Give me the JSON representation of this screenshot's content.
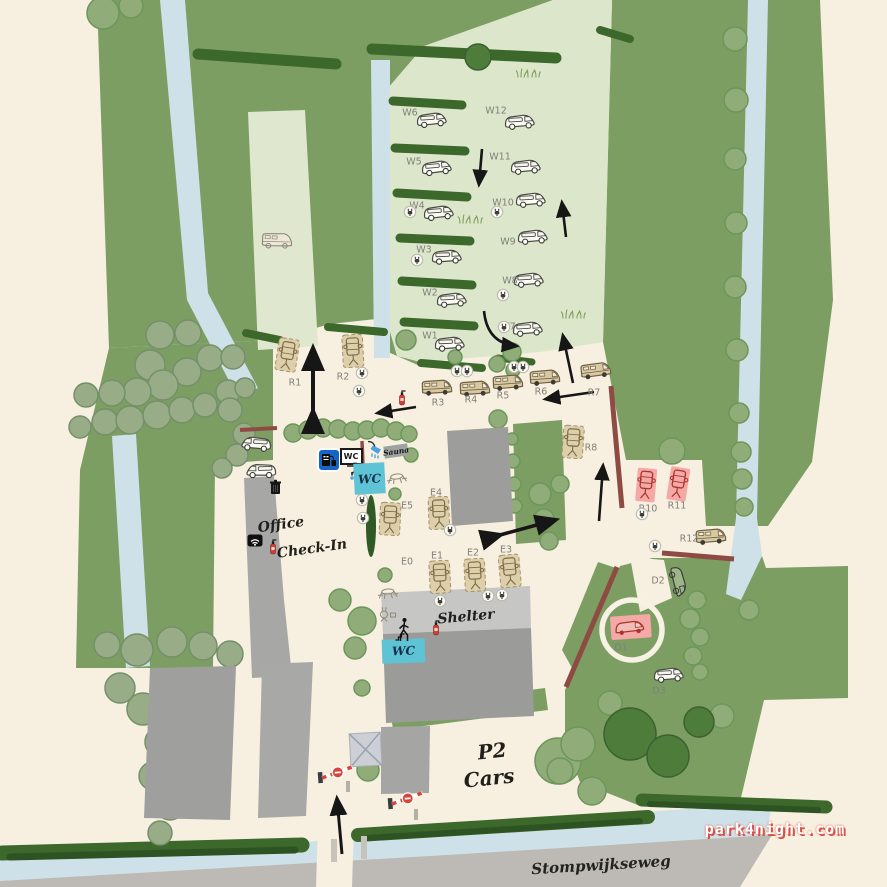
{
  "watermark": "park4night.com",
  "road_name": "Stompwijkseweg",
  "colors": {
    "cream": "#f7efe0",
    "field_green": "#7d9e63",
    "light_field": "#dce6cb",
    "water": "#cfe1e8",
    "hedge": "#3c682c",
    "road": "#bdbab5",
    "fence": "#8d4b43",
    "wc_teal": "#5fc3d6",
    "pink_spot": "#f5a9a6",
    "red_sketch": "#a8352c",
    "service_blue": "#1565c5",
    "arrow": "#161616"
  },
  "area_labels": [
    {
      "id": "office",
      "text": "Office",
      "x": 281,
      "y": 525,
      "size": 14,
      "rot": -8
    },
    {
      "id": "check-in",
      "text": "Check-In",
      "x": 312,
      "y": 549,
      "size": 14,
      "rot": -8
    },
    {
      "id": "shelter",
      "text": "Shelter",
      "x": 466,
      "y": 617,
      "size": 14,
      "rot": -5
    },
    {
      "id": "p2",
      "text": "P2",
      "x": 492,
      "y": 751,
      "size": 20,
      "rot": -6
    },
    {
      "id": "cars",
      "text": "Cars",
      "x": 489,
      "y": 778,
      "size": 20,
      "rot": -6
    }
  ],
  "pitches": [
    {
      "id": "W1",
      "type": "van",
      "x": 450,
      "y": 345,
      "r": -2,
      "lx": 430,
      "ly": 336
    },
    {
      "id": "W2",
      "type": "van",
      "x": 452,
      "y": 301,
      "r": -3,
      "lx": 430,
      "ly": 293
    },
    {
      "id": "W3",
      "type": "van",
      "x": 447,
      "y": 258,
      "r": -2,
      "lx": 424,
      "ly": 250
    },
    {
      "id": "W4",
      "type": "van",
      "x": 439,
      "y": 214,
      "r": -4,
      "lx": 417,
      "ly": 206
    },
    {
      "id": "W5",
      "type": "van",
      "x": 437,
      "y": 169,
      "r": -5,
      "lx": 414,
      "ly": 162
    },
    {
      "id": "W6",
      "type": "van",
      "x": 432,
      "y": 121,
      "r": -4,
      "lx": 410,
      "ly": 113
    },
    {
      "id": "W7",
      "type": "van",
      "x": 528,
      "y": 330,
      "r": -3,
      "lx": 508,
      "ly": 327
    },
    {
      "id": "W8",
      "type": "van",
      "x": 529,
      "y": 281,
      "r": -3,
      "lx": 510,
      "ly": 281
    },
    {
      "id": "W9",
      "type": "van",
      "x": 533,
      "y": 238,
      "r": -3,
      "lx": 508,
      "ly": 242
    },
    {
      "id": "W10",
      "type": "van",
      "x": 531,
      "y": 201,
      "r": -3,
      "lx": 503,
      "ly": 203
    },
    {
      "id": "W11",
      "type": "van",
      "x": 526,
      "y": 168,
      "r": -3,
      "lx": 500,
      "ly": 157
    },
    {
      "id": "W12",
      "type": "van",
      "x": 520,
      "y": 123,
      "r": -3,
      "lx": 496,
      "ly": 111
    },
    {
      "id": "R1",
      "type": "plot",
      "x": 287,
      "y": 357,
      "r": 9,
      "lx": 295,
      "ly": 383
    },
    {
      "id": "R2",
      "type": "plot",
      "x": 353,
      "y": 353,
      "r": -3,
      "lx": 343,
      "ly": 377
    },
    {
      "id": "R3",
      "type": "rv",
      "x": 437,
      "y": 389,
      "r": -2,
      "lx": 438,
      "ly": 403
    },
    {
      "id": "R4",
      "type": "rv",
      "x": 475,
      "y": 390,
      "r": -2,
      "lx": 471,
      "ly": 400
    },
    {
      "id": "R5",
      "type": "rv",
      "x": 508,
      "y": 384,
      "r": -3,
      "lx": 503,
      "ly": 396
    },
    {
      "id": "R6",
      "type": "rv",
      "x": 545,
      "y": 379,
      "r": -3,
      "lx": 541,
      "ly": 392
    },
    {
      "id": "R7",
      "type": "rv",
      "x": 596,
      "y": 372,
      "r": -6,
      "lx": 594,
      "ly": 393
    },
    {
      "id": "R8",
      "type": "plot",
      "x": 573,
      "y": 444,
      "r": 4,
      "lx": 591,
      "ly": 448
    },
    {
      "id": "R10",
      "type": "pinkplot",
      "x": 646,
      "y": 487,
      "r": 5,
      "lx": 648,
      "ly": 509
    },
    {
      "id": "R11",
      "type": "pinkplot",
      "x": 678,
      "y": 486,
      "r": 9,
      "lx": 677,
      "ly": 506
    },
    {
      "id": "R12",
      "type": "rv",
      "x": 711,
      "y": 538,
      "r": -3,
      "lx": 689,
      "ly": 539
    },
    {
      "id": "E0",
      "type": "none",
      "x": 407,
      "y": 562,
      "r": 0,
      "lx": 407,
      "ly": 562
    },
    {
      "id": "E1",
      "type": "plot",
      "x": 440,
      "y": 579,
      "r": -3,
      "lx": 437,
      "ly": 556
    },
    {
      "id": "E2",
      "type": "plot",
      "x": 475,
      "y": 577,
      "r": -3,
      "lx": 473,
      "ly": 553
    },
    {
      "id": "E3",
      "type": "plot",
      "x": 510,
      "y": 573,
      "r": -5,
      "lx": 506,
      "ly": 550
    },
    {
      "id": "E4",
      "type": "plot",
      "x": 439,
      "y": 515,
      "r": -2,
      "lx": 436,
      "ly": 493
    },
    {
      "id": "E5",
      "type": "plot",
      "x": 390,
      "y": 521,
      "r": 3,
      "lx": 407,
      "ly": 506
    },
    {
      "id": "D1",
      "type": "pinkvan",
      "x": 631,
      "y": 629,
      "r": -4,
      "lx": 621,
      "ly": 648
    },
    {
      "id": "D2",
      "type": "vanv",
      "x": 677,
      "y": 582,
      "r": 78,
      "lx": 658,
      "ly": 581
    },
    {
      "id": "D3",
      "type": "van",
      "x": 669,
      "y": 676,
      "r": -3,
      "lx": 659,
      "ly": 691
    }
  ],
  "amenities": [
    {
      "t": "service",
      "n": "service-station-sign",
      "x": 329,
      "y": 462,
      "r": 0
    },
    {
      "t": "wcsign",
      "n": "wc-sign",
      "x": 349,
      "y": 454,
      "r": 0,
      "text": "WC"
    },
    {
      "t": "tap",
      "n": "water-tap-icon",
      "x": 352,
      "y": 472,
      "r": 0
    },
    {
      "t": "shower",
      "n": "shower-icon",
      "x": 374,
      "y": 452,
      "r": 0
    },
    {
      "t": "saunasign",
      "n": "sauna-sign",
      "x": 396,
      "y": 451,
      "r": -8,
      "text": "Sauna"
    },
    {
      "t": "wcb",
      "n": "wc-building",
      "x": 369,
      "y": 478,
      "w": 31,
      "h": 31,
      "r": -3,
      "text": "WC"
    },
    {
      "t": "wcb",
      "n": "wc-building",
      "x": 403,
      "y": 651,
      "w": 43,
      "h": 24,
      "r": -2,
      "text": "WC"
    },
    {
      "t": "wifi",
      "n": "wifi-icon",
      "x": 255,
      "y": 542,
      "r": 0
    },
    {
      "t": "ext",
      "n": "fire-extinguisher-icon",
      "x": 273,
      "y": 549,
      "r": 0
    },
    {
      "t": "ext",
      "n": "fire-extinguisher-icon",
      "x": 402,
      "y": 400,
      "r": 0
    },
    {
      "t": "ext",
      "n": "fire-extinguisher-icon",
      "x": 436,
      "y": 630,
      "r": 0
    },
    {
      "t": "trash",
      "n": "trash-bin-icon",
      "x": 276,
      "y": 489,
      "r": 0
    },
    {
      "t": "picnic",
      "n": "picnic-table-icon",
      "x": 397,
      "y": 479,
      "r": -8
    },
    {
      "t": "picnic",
      "n": "picnic-table-icon",
      "x": 388,
      "y": 594,
      "r": -5
    },
    {
      "t": "person",
      "n": "person-stairs-icon",
      "x": 403,
      "y": 632,
      "r": 0
    },
    {
      "t": "grill",
      "n": "grill-icon",
      "x": 387,
      "y": 616,
      "r": 0
    },
    {
      "t": "grass",
      "n": "grass-tuft",
      "x": 528,
      "y": 73,
      "r": 0
    },
    {
      "t": "grass",
      "n": "grass-tuft",
      "x": 470,
      "y": 219,
      "r": 0
    },
    {
      "t": "grass",
      "n": "grass-tuft",
      "x": 573,
      "y": 314,
      "r": 0
    },
    {
      "t": "grass",
      "n": "grass-tuft",
      "x": 716,
      "y": 600,
      "r": 0
    },
    {
      "t": "barrier",
      "n": "entry-barrier",
      "x": 336,
      "y": 776,
      "r": -4
    },
    {
      "t": "barrier",
      "n": "entry-barrier",
      "x": 406,
      "y": 802,
      "r": -4
    },
    {
      "t": "vanl",
      "n": "campervan-icon",
      "x": 256,
      "y": 445,
      "r": 3
    },
    {
      "t": "vanl",
      "n": "campervan-icon",
      "x": 261,
      "y": 472,
      "r": -2
    },
    {
      "t": "rvsketch",
      "n": "motorhome-icon",
      "x": 277,
      "y": 242,
      "r": 2
    }
  ],
  "hookups": [
    [
      410,
      213
    ],
    [
      497,
      213
    ],
    [
      417,
      261
    ],
    [
      503,
      296
    ],
    [
      504,
      328
    ],
    [
      362,
      374
    ],
    [
      359,
      392
    ],
    [
      457,
      372
    ],
    [
      467,
      372
    ],
    [
      514,
      368
    ],
    [
      523,
      368
    ],
    [
      362,
      501
    ],
    [
      363,
      519
    ],
    [
      450,
      531
    ],
    [
      440,
      602
    ],
    [
      488,
      597
    ],
    [
      502,
      596
    ],
    [
      642,
      515
    ],
    [
      655,
      547
    ]
  ]
}
